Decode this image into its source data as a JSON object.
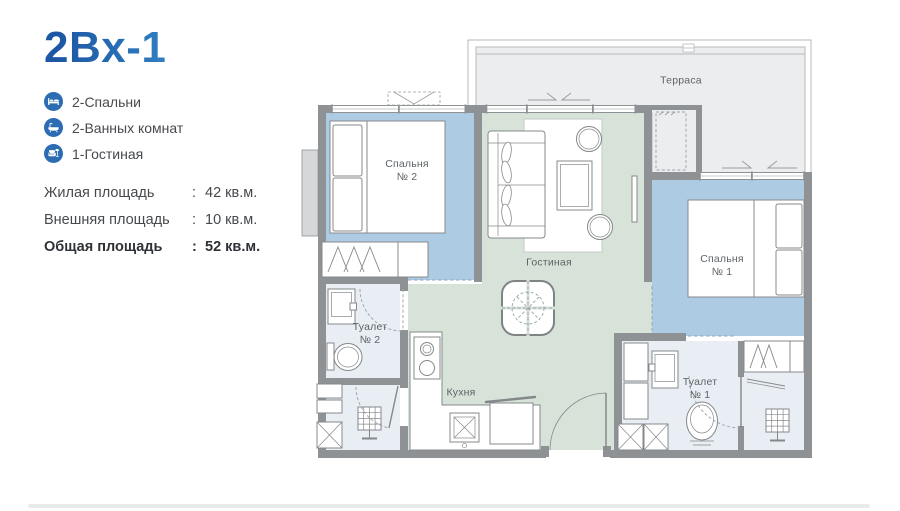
{
  "header": {
    "title": "2Bx-1"
  },
  "features": [
    {
      "icon": "bed-icon",
      "label": "2-Спальни"
    },
    {
      "icon": "bathtub-icon",
      "label": "2-Ванных комнат"
    },
    {
      "icon": "armchair-icon",
      "label": "1-Гостиная"
    }
  ],
  "areas": {
    "rows": [
      {
        "label": "Жилая площадь",
        "colon": ":",
        "value": "42 кв.м."
      },
      {
        "label": "Внешняя площадь",
        "colon": ":",
        "value": "10 кв.м."
      },
      {
        "label": "Общая площадь",
        "colon": ":",
        "value": "52 кв.м."
      }
    ]
  },
  "floorplan": {
    "labels": {
      "terrace": "Терраса",
      "bedroom2_line1": "Спальня",
      "bedroom2_line2": "№ 2",
      "living": "Гостиная",
      "bedroom1_line1": "Спальня",
      "bedroom1_line2": "№ 1",
      "toilet2_line1": "Туалет",
      "toilet2_line2": "№ 2",
      "kitchen": "Кухня",
      "toilet1_line1": "Туалет",
      "toilet1_line2": "№ 1"
    }
  },
  "colors": {
    "title_start": "#1d57a3",
    "title_mid": "#2f7cc0",
    "title_end": "#48a3dd",
    "icon_bg": "#2b6cb3",
    "text": "#46494d",
    "wall": "#8f9295",
    "wall_light": "#b7b9bb",
    "bedroom": "#aecbe4",
    "living": "#d7e3d8",
    "bath": "#e8eef4",
    "terrace": "#ecedef",
    "furniture": "#85888b",
    "plan_text": "#5d6367",
    "footer_line": "#e9eaea"
  }
}
